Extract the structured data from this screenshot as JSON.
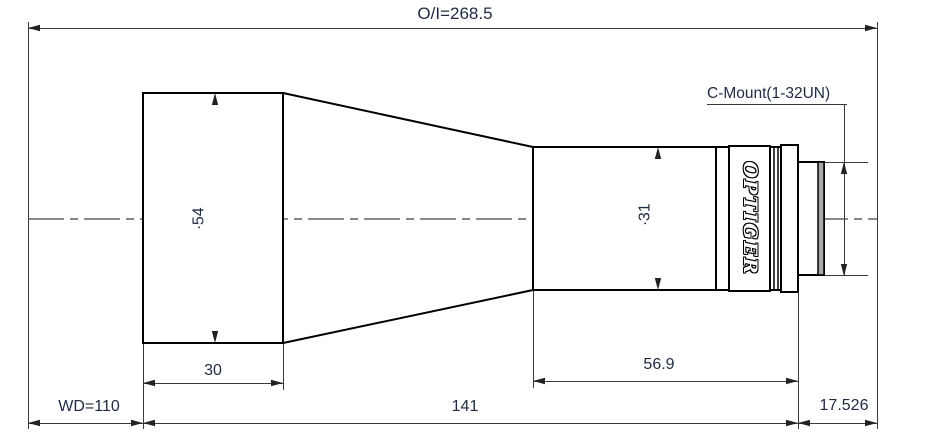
{
  "drawing": {
    "overall_dimension": "O/I=268.5",
    "mount_label": "C-Mount(1-32UN)",
    "brand": "OPTIGER",
    "dimensions": {
      "front_diameter": "∙54",
      "barrel_diameter": "∙31",
      "front_section_length": "30",
      "barrel_section_length": "56.9",
      "working_distance": "WD=110",
      "lens_body_length": "141",
      "flange_focal_distance": "17.526"
    },
    "colors": {
      "background": "#ffffff",
      "object_line": "#000000",
      "dimension_line": "#3a3a3a",
      "dimension_text": "#1d2a42"
    }
  }
}
